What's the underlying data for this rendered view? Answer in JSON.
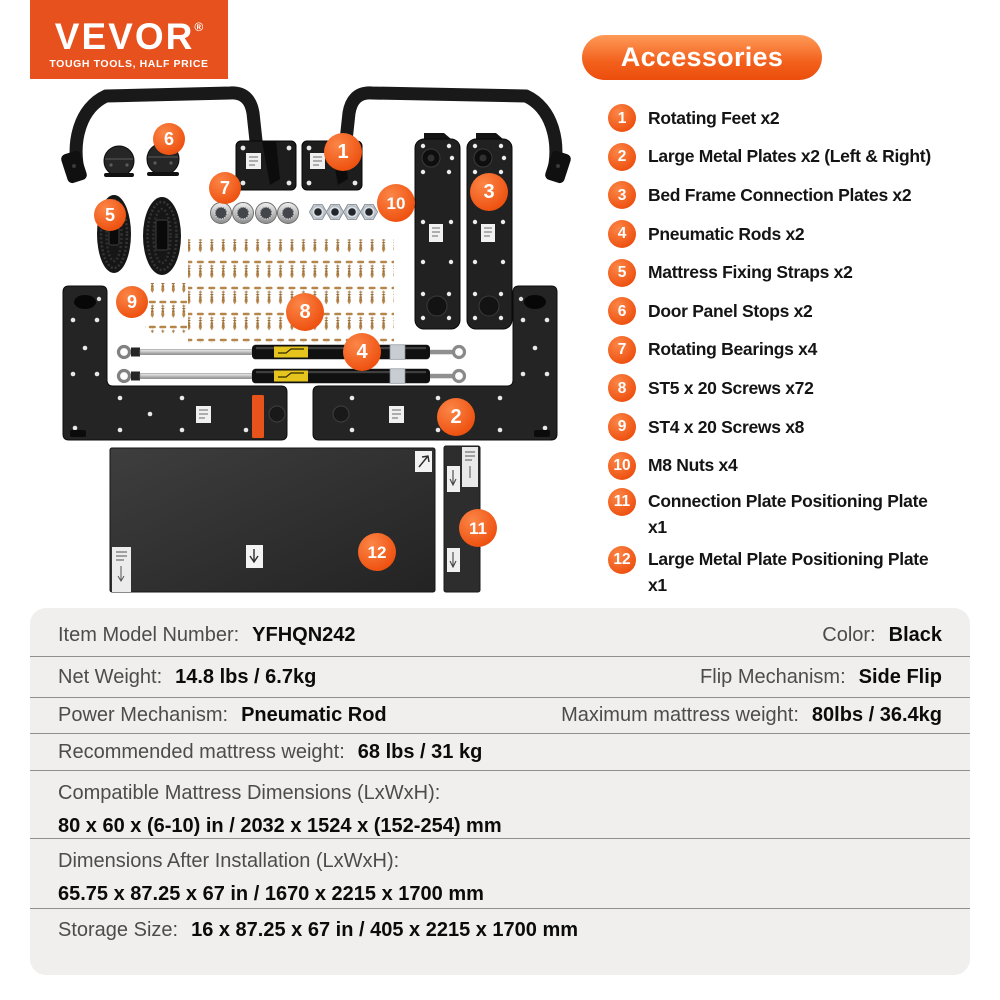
{
  "brand": {
    "name": "VEVOR",
    "reg": "®",
    "tagline": "TOUGH TOOLS, HALF PRICE"
  },
  "colors": {
    "accent_orange": "#ee5110",
    "logo_orange": "#e6511d",
    "table_bg": "#f0efee",
    "divider_gray": "#8f8f8f",
    "screw_gold": "#b5854a"
  },
  "accessories": {
    "title": "Accessories",
    "items": [
      {
        "num": "1",
        "label": "Rotating Feet x2"
      },
      {
        "num": "2",
        "label": "Large Metal Plates x2 (Left & Right)"
      },
      {
        "num": "3",
        "label": "Bed Frame Connection Plates x2"
      },
      {
        "num": "4",
        "label": "Pneumatic Rods x2"
      },
      {
        "num": "5",
        "label": "Mattress Fixing Straps x2"
      },
      {
        "num": "6",
        "label": "Door Panel Stops x2"
      },
      {
        "num": "7",
        "label": "Rotating Bearings x4"
      },
      {
        "num": "8",
        "label": "ST5 x 20 Screws x72"
      },
      {
        "num": "9",
        "label": "ST4 x 20 Screws x8"
      },
      {
        "num": "10",
        "label": "M8 Nuts x4"
      },
      {
        "num": "11",
        "label": "Connection Plate Positioning Plate x1"
      },
      {
        "num": "12",
        "label": "Large Metal Plate Positioning Plate x1"
      }
    ]
  },
  "diagram": {
    "badges": [
      "1",
      "2",
      "3",
      "4",
      "5",
      "6",
      "7",
      "8",
      "9",
      "10",
      "11",
      "12"
    ]
  },
  "spec": {
    "rows": [
      {
        "cells": [
          {
            "label": "Item Model Number:",
            "value": "YFHQN242"
          },
          {
            "label": "Color:",
            "value": "Black"
          }
        ]
      },
      {
        "cells": [
          {
            "label": "Net Weight:",
            "value": "14.8 lbs / 6.7kg"
          },
          {
            "label": "Flip Mechanism:",
            "value": "Side Flip"
          }
        ]
      },
      {
        "cells": [
          {
            "label": "Power Mechanism:",
            "value": "Pneumatic Rod"
          },
          {
            "label": "Maximum mattress weight:",
            "value": "80lbs / 36.4kg"
          }
        ]
      },
      {
        "cells": [
          {
            "label": "Recommended mattress weight:",
            "value": "68 lbs / 31 kg"
          }
        ]
      },
      {
        "label": "Compatible Mattress Dimensions (LxWxH):",
        "value": "80 x 60 x (6-10) in / 2032 x 1524 x (152-254) mm"
      },
      {
        "label": "Dimensions After Installation (LxWxH):",
        "value": "65.75 x 87.25 x 67 in / 1670 x 2215 x 1700 mm"
      },
      {
        "cells": [
          {
            "label": "Storage Size:",
            "value": "16 x 87.25 x 67 in / 405 x 2215 x 1700 mm"
          }
        ]
      }
    ]
  }
}
